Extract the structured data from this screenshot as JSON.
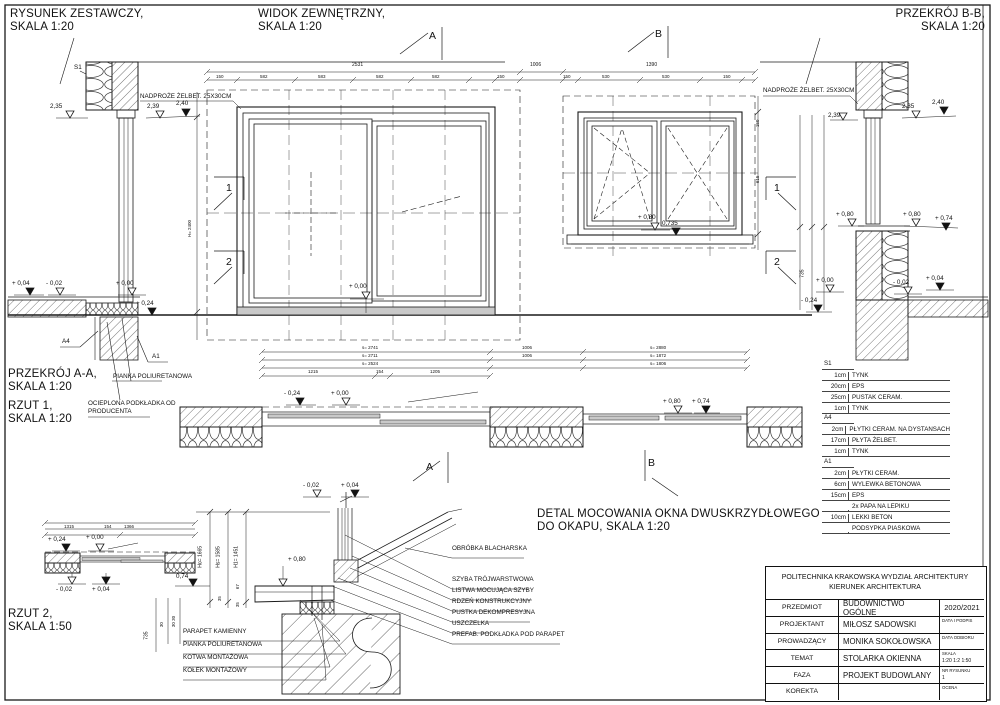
{
  "titles": {
    "zestawczy": [
      "RYSUNEK ZESTAWCZY,",
      "SKALA 1:20"
    ],
    "widok": [
      "WIDOK ZEWNĘTRZNY,",
      "SKALA 1:20"
    ],
    "przekroj_bb": [
      "PRZEKRÓJ B-B,",
      "SKALA 1:20"
    ],
    "przekroj_aa": [
      "PRZEKRÓJ A-A,",
      "SKALA 1:20"
    ],
    "rzut1": [
      "RZUT 1,",
      "SKALA 1:20"
    ],
    "rzut2": [
      "RZUT 2,",
      "SKALA 1:50"
    ],
    "detal": [
      "DETAL MOCOWANIA OKNA DWUSKRZYDŁOWEGO",
      "DO OKAPU, SKALA 1:20"
    ]
  },
  "annotations": {
    "nadproze": "NADPROŻE ŻELBET. 25X30CM",
    "pianka": "PIANKA POLIURETANOWA",
    "ocieplona": [
      "OCIEPLONA PODKŁADKA OD",
      "PRODUCENTA"
    ],
    "s1": "S1",
    "a4": "A4",
    "a1": "A1"
  },
  "markers": {
    "a": "A",
    "b": "B",
    "n1": "1",
    "n2": "2"
  },
  "marks": {
    "p235": "2,35",
    "p239": "2,39",
    "p240": "2,40",
    "p080": "+ 0,80",
    "p0735": "0,735",
    "p000": "+ 0,00",
    "p024": "+ 0,24",
    "n024": "- 0,24",
    "n002": "- 0,02",
    "p004": "+ 0,04",
    "p074": "+ 0,74",
    "p074b": "0,74"
  },
  "dims": {
    "w2531": "2531",
    "w1006": "1006",
    "w1390": "1390",
    "s150": "150",
    "s582": "582",
    "s583": "583",
    "s530": "530",
    "c2741": "s= 2741",
    "c2711": "s= 2711",
    "c2524": "s= 2524",
    "c1215": "1215",
    "c154": "154",
    "c1205": "1205",
    "r2880": "s= 2880",
    "r1872": "s= 1872",
    "r1806": "s= 1806",
    "c1315": "1315",
    "c1366": "1366",
    "h2400": "H= 2400",
    "d615": "615",
    "h735": "735",
    "d30": "30",
    "d3030": "30 30",
    "d35": "35",
    "d67": "67",
    "ho": "Ho= 1665",
    "hs": "Hs= 1585",
    "h1": "H1= 1451"
  },
  "legend": {
    "s1": {
      "code": "S1",
      "rows": [
        [
          "1cm",
          "TYNK"
        ],
        [
          "20cm",
          "EPS"
        ],
        [
          "25cm",
          "PUSTAK CERAM."
        ],
        [
          "1cm",
          "TYNK"
        ]
      ]
    },
    "a4": {
      "code": "A4",
      "rows": [
        [
          "2cm",
          "PŁYTKI CERAM. NA DYSTANSACH"
        ],
        [
          "17cm",
          "PŁYTA ŻELBET."
        ],
        [
          "1cm",
          "TYNK"
        ]
      ]
    },
    "a1": {
      "code": "A1",
      "rows": [
        [
          "2cm",
          "PŁYTKI CERAM."
        ],
        [
          "6cm",
          "WYLEWKA BETONOWA"
        ],
        [
          "15cm",
          "EPS"
        ],
        [
          "",
          "2x PAPA NA LEPIKU"
        ],
        [
          "10cm",
          "LEKKI BETON"
        ],
        [
          "",
          "PODSYPKA PIASKOWA"
        ]
      ]
    }
  },
  "detail": {
    "callouts": [
      "OBRÓBKA BLACHARSKA",
      "SZYBA TRÓJWARSTWOWA",
      "LISTWA MOCUJĄCA SZYBY",
      "RDZEŃ KONSTRUKCYJNY",
      "PUSTKA DEKOMPRESYJNA",
      "USZCZELKA",
      "PREFAB. PODKŁADKA POD PARAPET"
    ],
    "left_labels": [
      "PARAPET KAMIENNY",
      "PIANKA POLIURETANOWA",
      "KOTWA MONTAŻOWA",
      "KOŁEK MONTAŻOWY"
    ]
  },
  "titleblock": {
    "header": [
      "POLITECHNIKA KRAKOWSKA WYDZIAŁ ARCHITEKTURY",
      "KIERUNEK ARCHITEKTURA"
    ],
    "rows": [
      {
        "label": "PRZEDMIOT",
        "value": "BUDOWNICTWO OGÓLNE",
        "side": "2020/2021",
        "side2": ""
      },
      {
        "label": "PROJEKTANT",
        "value": "MIŁOSZ SADOWSKI",
        "side": "DATA I PODPIS",
        "side2": ""
      },
      {
        "label": "PROWADZĄCY",
        "value": "MONIKA SOKOŁOWSKA",
        "side": "DATA ODBIORU",
        "side2": ""
      },
      {
        "label": "TEMAT",
        "value": "STOLARKA OKIENNA",
        "side": "SKALA",
        "side2": "1:20 1:2 1:50"
      },
      {
        "label": "FAZA",
        "value": "PROJEKT BUDOWLANY",
        "side": "NR RYSUNKU",
        "side2": "1"
      },
      {
        "label": "KOREKTA",
        "value": "",
        "side": "OCENA",
        "side2": ""
      }
    ]
  }
}
